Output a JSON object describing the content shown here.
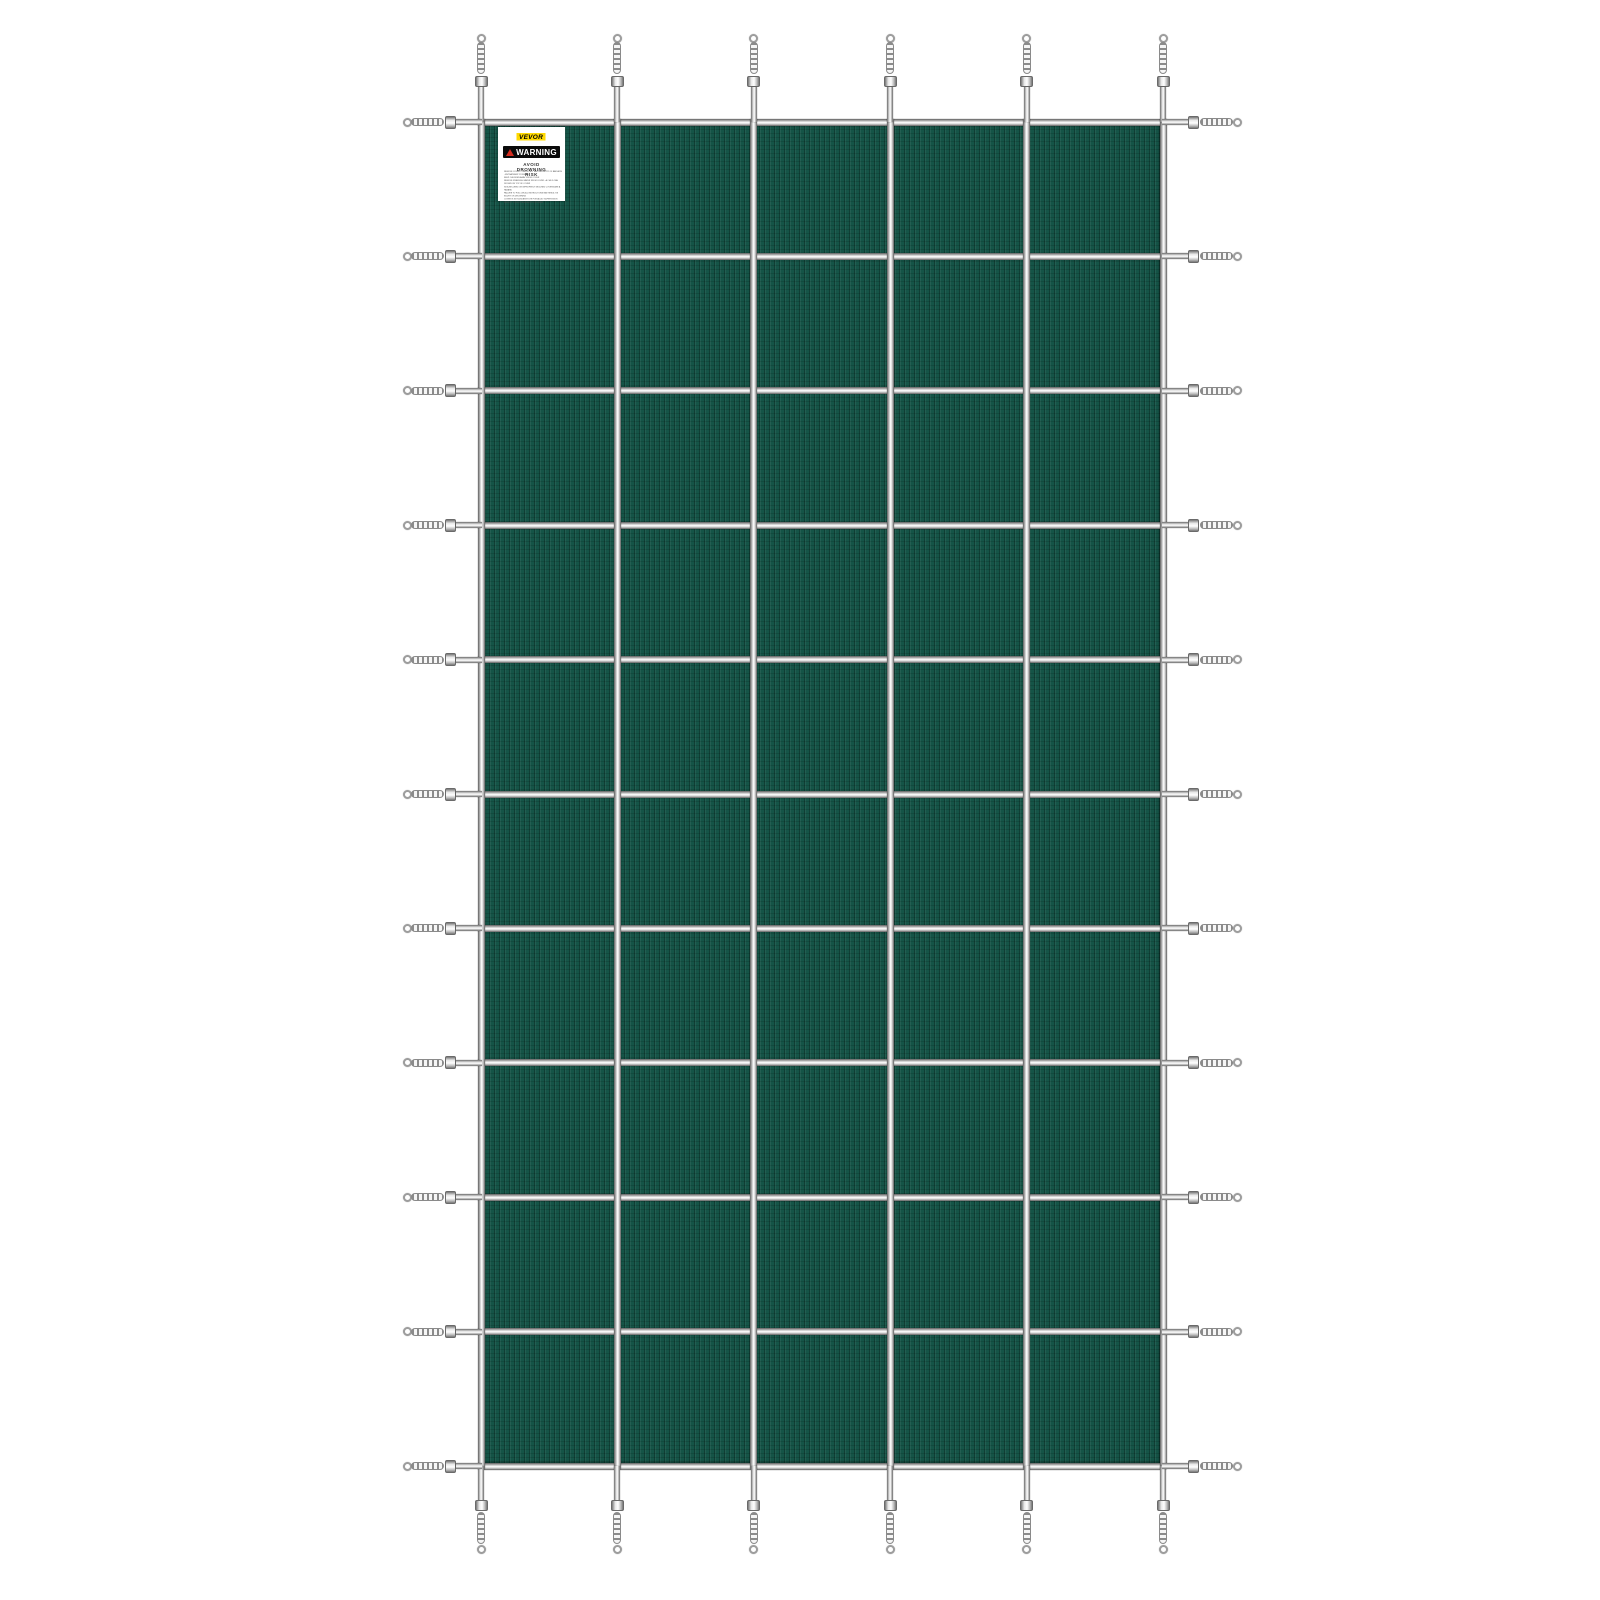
{
  "page": {
    "background": "#ffffff"
  },
  "product": {
    "name": "pool-safety-cover",
    "mesh_color": "#155447",
    "strap_color_light": "#ffffff",
    "strap_color_dark": "#5f5f5f",
    "grid": {
      "columns": 5,
      "rows": 10,
      "vertical_straps": 6,
      "horizontal_straps": 11
    },
    "springs": {
      "top": 6,
      "bottom": 6,
      "left": 11,
      "right": 11
    }
  },
  "label": {
    "brand": "VEVOR",
    "warning_word": "WARNING",
    "risk_heading": "AVOID DROWNING RISK",
    "accent_yellow": "#ffd900",
    "accent_red": "#d42b1e",
    "lines": [
      "REMOVE COVER COMPLETELY BEFORE ENTRY OF BATHERS - ENTRAPMENT POSSIBLE",
      "KEEP CHILDREN AWAY FROM COVER",
      "REMOVE STANDING WATER FROM COVER - A CHILD CAN DROWN ON TOP OF COVER",
      "NON-SECURED OR IMPROPERLY SECURED COVERS ARE A HAZARD",
      "FAILURE TO FOLLOW ALL INSTRUCTIONS MAY RESULT IN INJURY OR DROWNING",
      "COVER IS NOT A SUBSTITUTE FOR ADULT SUPERVISION",
      "INSPECT COVER REGULARLY FOR WEAR"
    ]
  }
}
